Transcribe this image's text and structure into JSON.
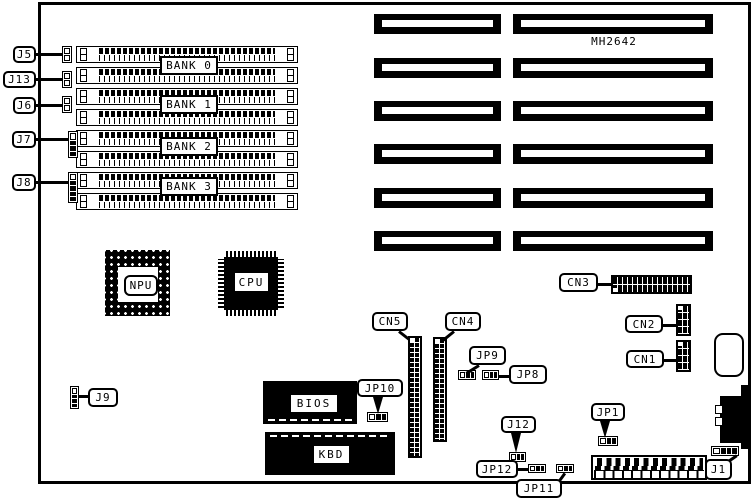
{
  "colors": {
    "ink": "#000000",
    "paper": "#ffffff"
  },
  "board": {
    "part_number": "MH2642"
  },
  "memory": {
    "bank_labels": [
      "BANK 0",
      "BANK 1",
      "BANK 2",
      "BANK 3"
    ]
  },
  "chips": {
    "npu": "NPU",
    "cpu": "CPU",
    "bios": "BIOS",
    "kbd": "KBD"
  },
  "labels": {
    "j5": "J5",
    "j13": "J13",
    "j6": "J6",
    "j7": "J7",
    "j8": "J8",
    "j9": "J9",
    "j12": "J12",
    "j1": "J1",
    "cn1": "CN1",
    "cn2": "CN2",
    "cn3": "CN3",
    "cn4": "CN4",
    "cn5": "CN5",
    "jp1": "JP1",
    "jp8": "JP8",
    "jp9": "JP9",
    "jp10": "JP10",
    "jp11": "JP11",
    "jp12": "JP12"
  }
}
